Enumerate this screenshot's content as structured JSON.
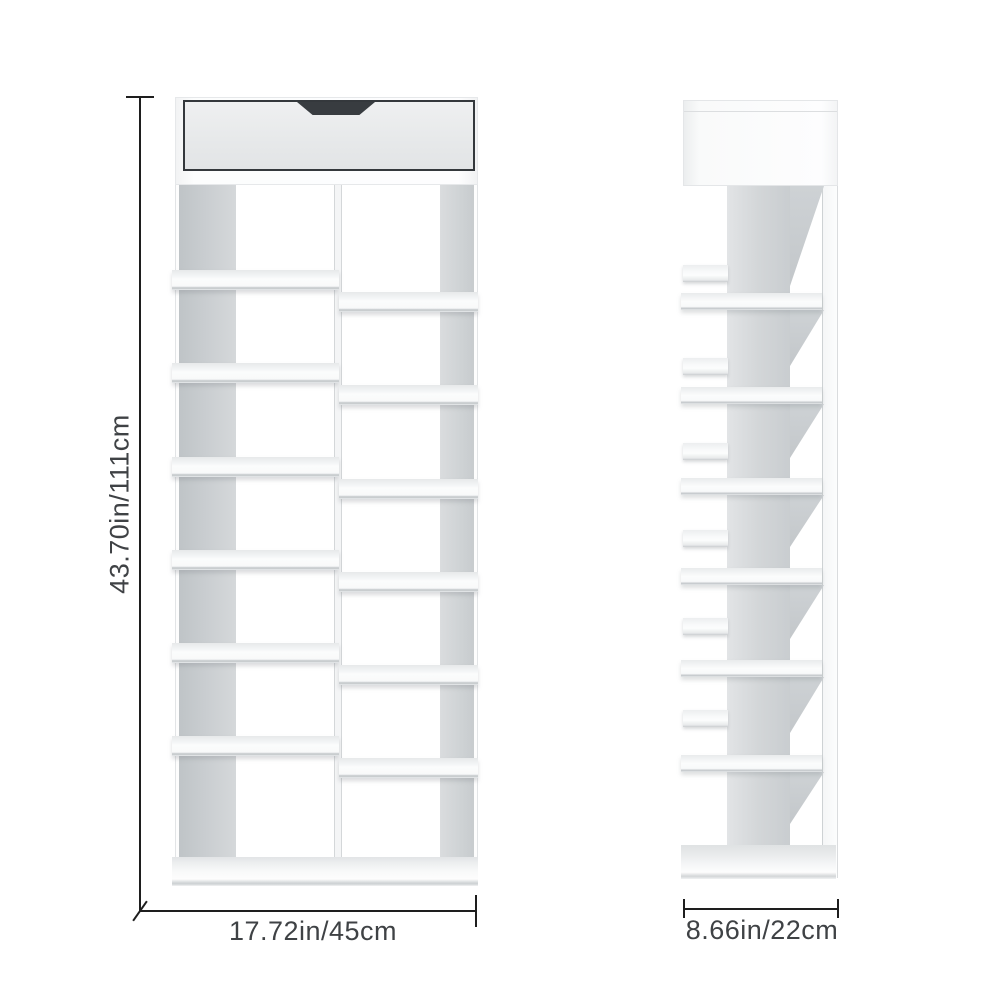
{
  "labels": {
    "height": "43.70in/111cm",
    "width": "17.72in/45cm",
    "depth": "8.66in/22cm"
  },
  "colors": {
    "background": "#ffffff",
    "furniture_white": "#fdfdfd",
    "panel_gray": "#c9cdd0",
    "drawer_outline": "#34383c",
    "drawer_notch": "#383c40",
    "dimension_line": "#1e1e1e",
    "label_text": "#3f4245"
  }
}
